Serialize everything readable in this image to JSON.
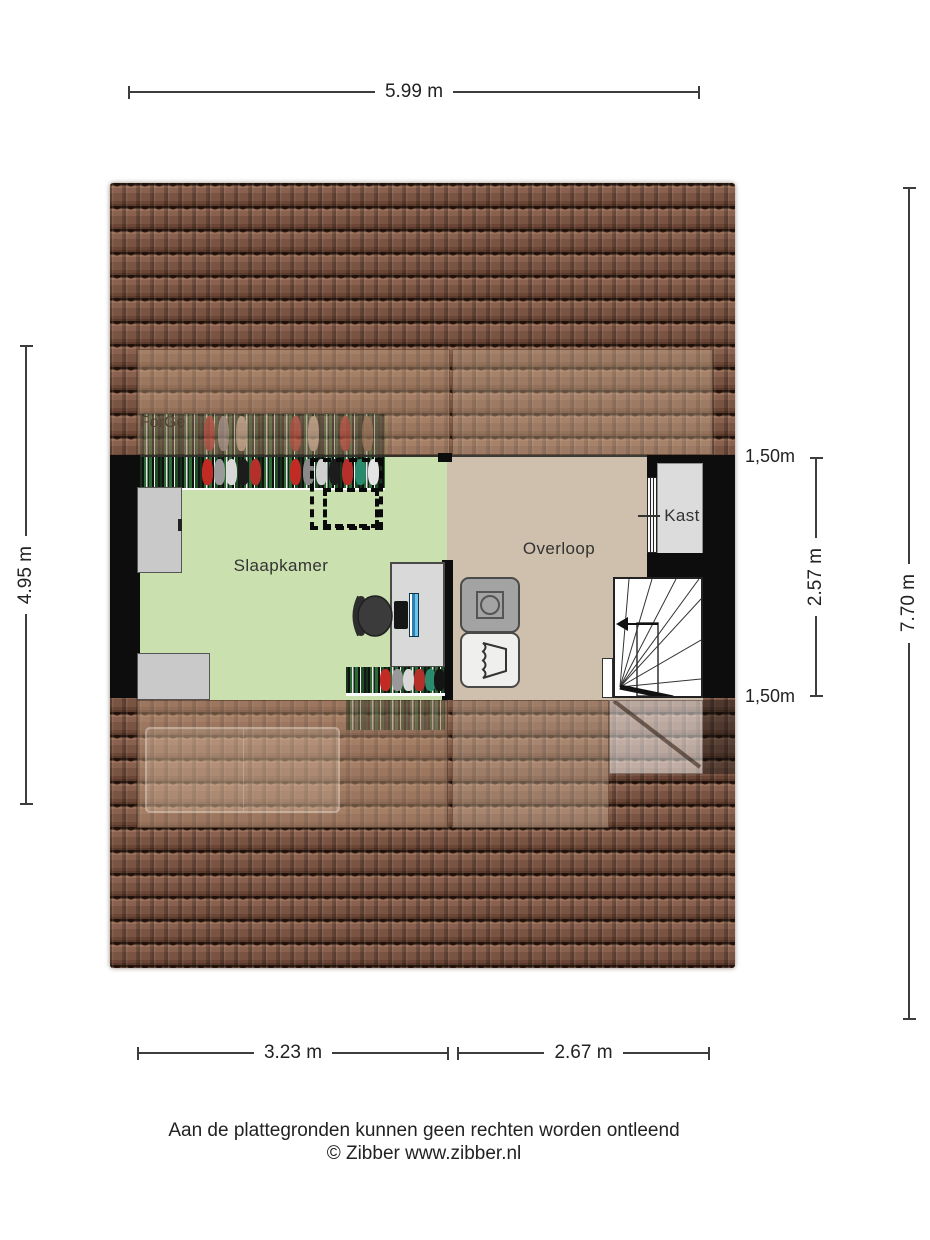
{
  "floorplan": {
    "rooms": [
      {
        "label": "Slaapkamer"
      },
      {
        "label": "Overloop"
      },
      {
        "label": "Kast"
      }
    ],
    "dimensions": {
      "top_width": "5.99 m",
      "left_height": "4.95 m",
      "right_total_height": "7.70 m",
      "right_inner_height": "2.57 m",
      "right_knee_wall_top": "1,50m",
      "right_knee_wall_bottom": "1,50m",
      "bottom_left_width": "3.23 m",
      "bottom_right_width": "2.67 m"
    },
    "colors": {
      "roof_base": "#7d5847",
      "bedroom_floor": "#cbe0af",
      "landing_floor": "#cec0ac",
      "closet_floor": "#dcdcdc",
      "wall": "#0d0d0d",
      "accent_monitor_blue": "#4aa5d4"
    },
    "icons": [
      "wardrobe-icon",
      "skylight-outline",
      "cabinet-icon",
      "desk-icon",
      "office-chair-icon",
      "monitor-icon",
      "washing-machine-icon",
      "laundry-basket-icon",
      "stairs-icon",
      "bed-ghost-icon",
      "closet-door-icon"
    ]
  },
  "footer": {
    "disclaimer": "Aan de plattegronden kunnen geen rechten worden ontleend",
    "copyright": "© Zibber www.zibber.nl"
  }
}
